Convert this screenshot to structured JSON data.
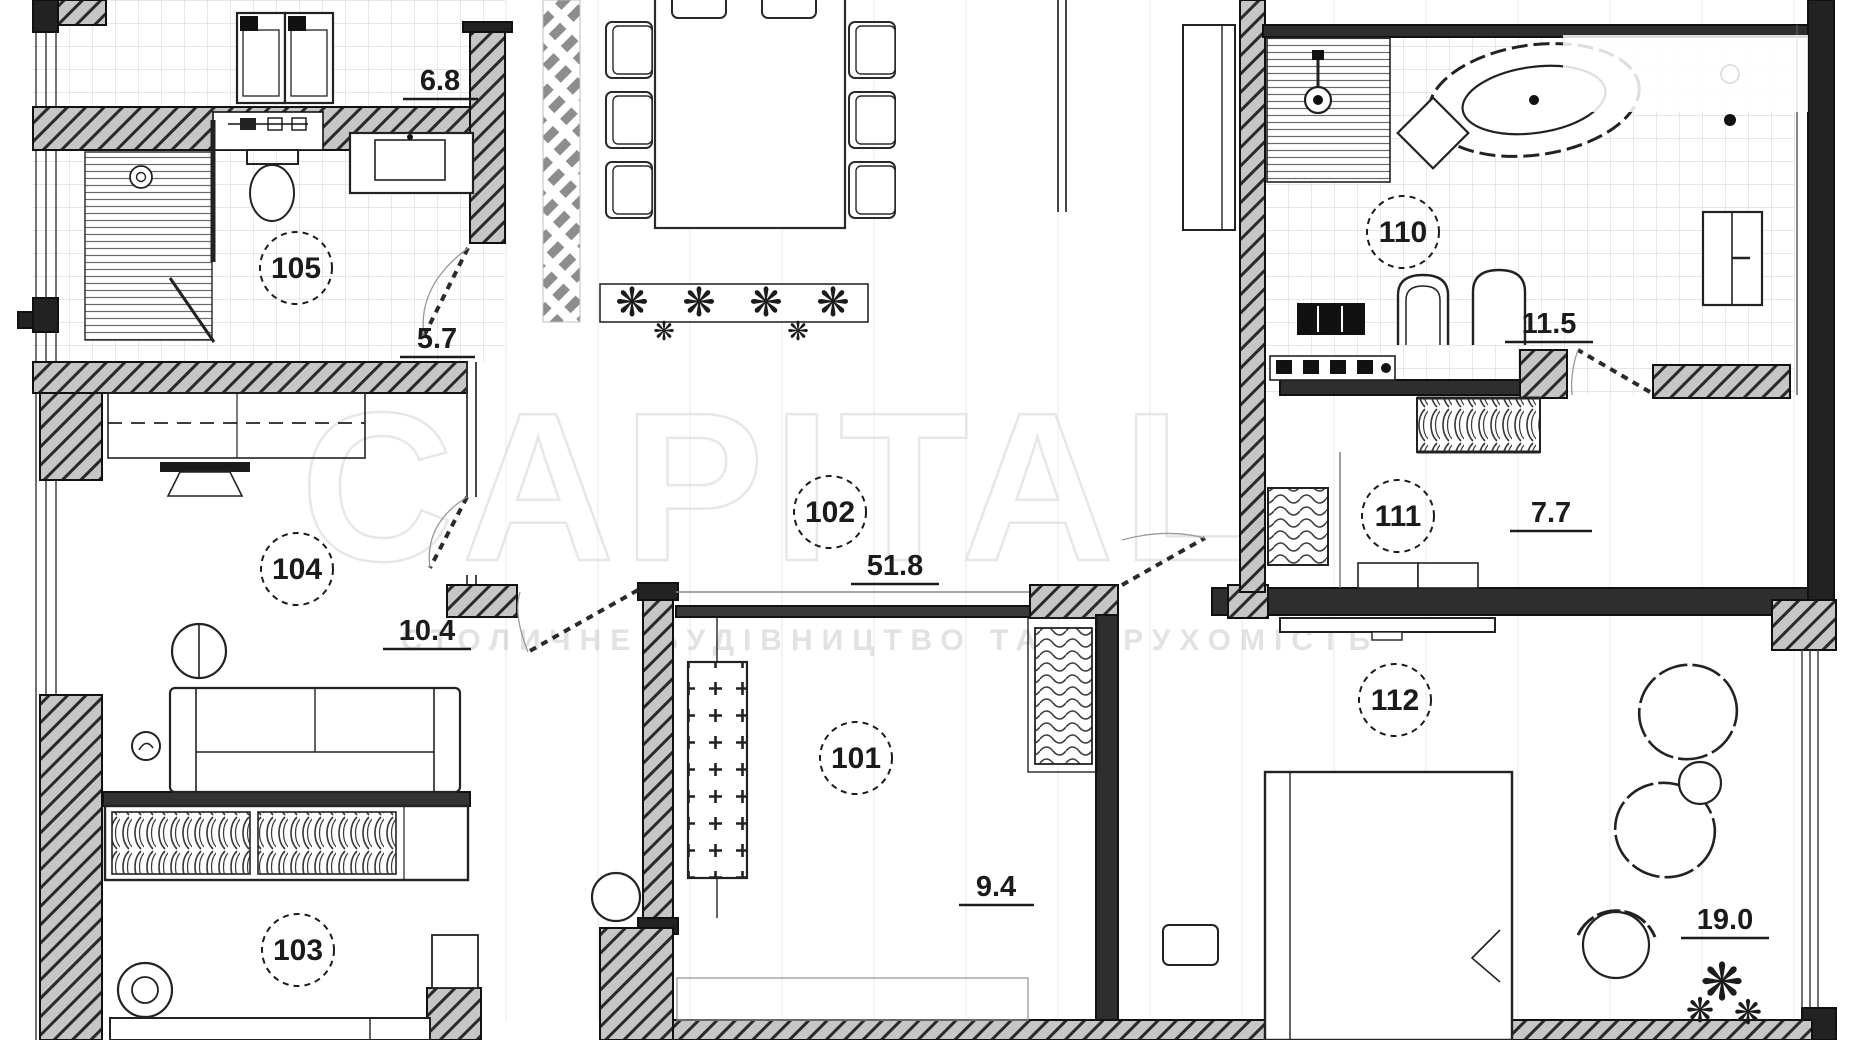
{
  "watermark": {
    "main": "CAPITAL",
    "sub": "СТОЛИЧНЕ БУДІВНИЦТВО ТА НЕРУХОМІСТЬ"
  },
  "rooms": {
    "r101": {
      "number": "101",
      "area": "9.4"
    },
    "r102": {
      "number": "102",
      "area": "51.8"
    },
    "r103": {
      "number": "103"
    },
    "r104": {
      "number": "104",
      "area": "10.4"
    },
    "r105": {
      "number": "105",
      "area": "5.7"
    },
    "r110": {
      "number": "110",
      "area": "11.5"
    },
    "r111": {
      "number": "111",
      "area": "7.7"
    },
    "r112": {
      "number": "112",
      "area": "19.0"
    }
  },
  "annotations": {
    "laundry_area": "6.8"
  },
  "colors": {
    "line": "#1b1b1b",
    "wall_hatch_bg": "#c6c6c6",
    "tile_grid": "#d8d8d8",
    "watermark": "#d4d4d4"
  }
}
